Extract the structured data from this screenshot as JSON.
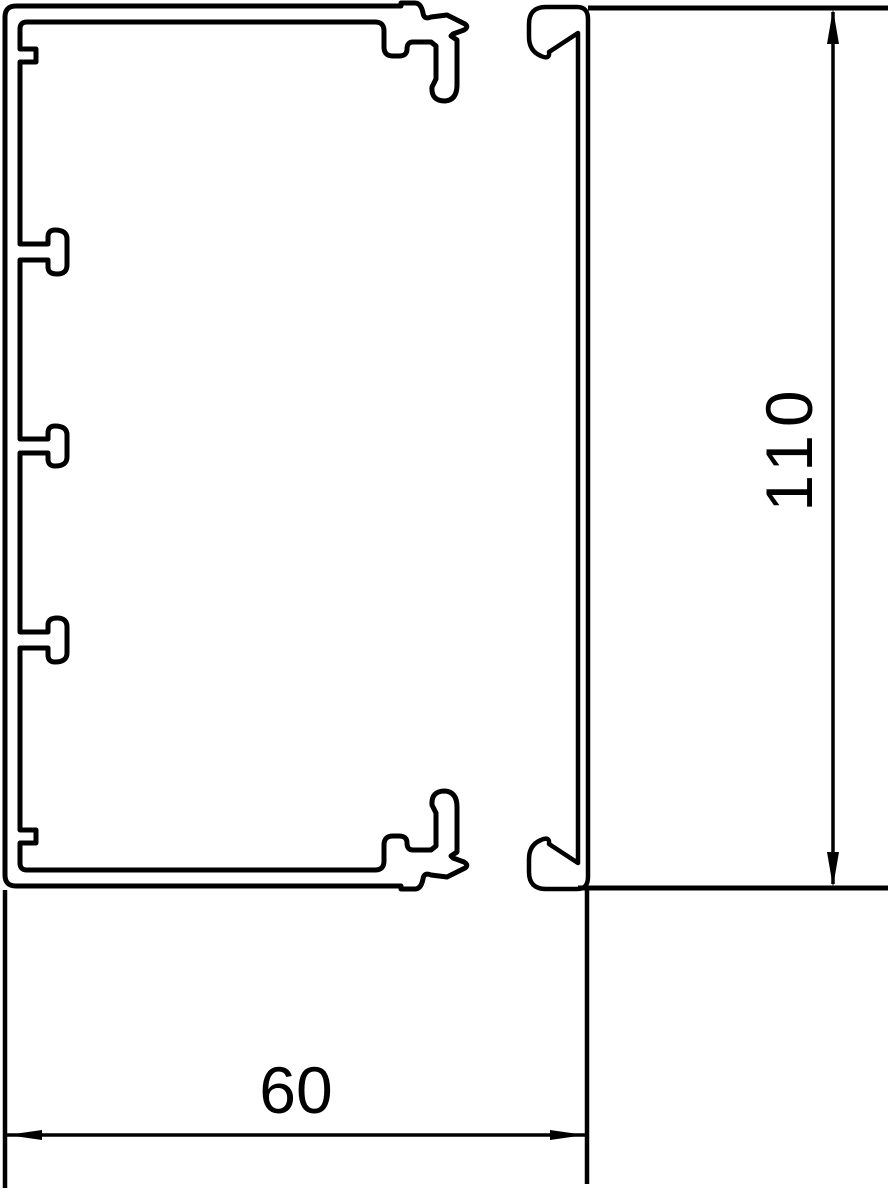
{
  "drawing": {
    "labels": {
      "width": "60",
      "height": "110"
    },
    "colors": {
      "line": "#000000",
      "background": "#ffffff"
    }
  }
}
